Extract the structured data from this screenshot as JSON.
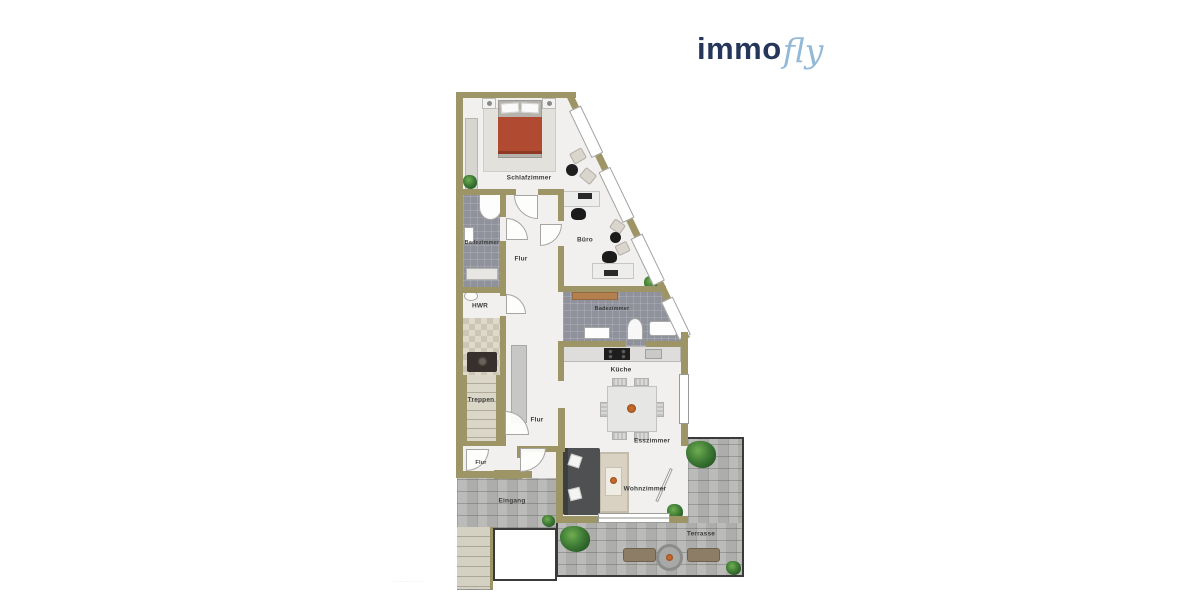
{
  "logo": {
    "part1": "immo",
    "part2": "fly"
  },
  "rooms": {
    "schlafzimmer": "Schlafzimmer",
    "badezimmer_1": "Badezimmer",
    "flur_1": "Flur",
    "buero": "Büro",
    "hwr": "HWR",
    "badezimmer_2": "Badezimmer",
    "kueche": "Küche",
    "treppen": "Treppen",
    "flur_2": "Flur",
    "esszimmer": "Esszimmer",
    "wohnzimmer": "Wohnzimmer",
    "flur_3": "Flur",
    "eingang": "Eingang",
    "terrasse": "Terrasse"
  },
  "colors": {
    "wall": "#9e9566",
    "floor": "#f1f0ee",
    "bath_tile": "#8f919b",
    "stone_paving": "#b6b6b4",
    "bed_cover": "#b04a30",
    "sofa": "#4e5052",
    "terrace_bench": "#8d7d66",
    "logo_immo": "#26365a",
    "logo_fly": "#93b9d9"
  },
  "footnote": "·············"
}
